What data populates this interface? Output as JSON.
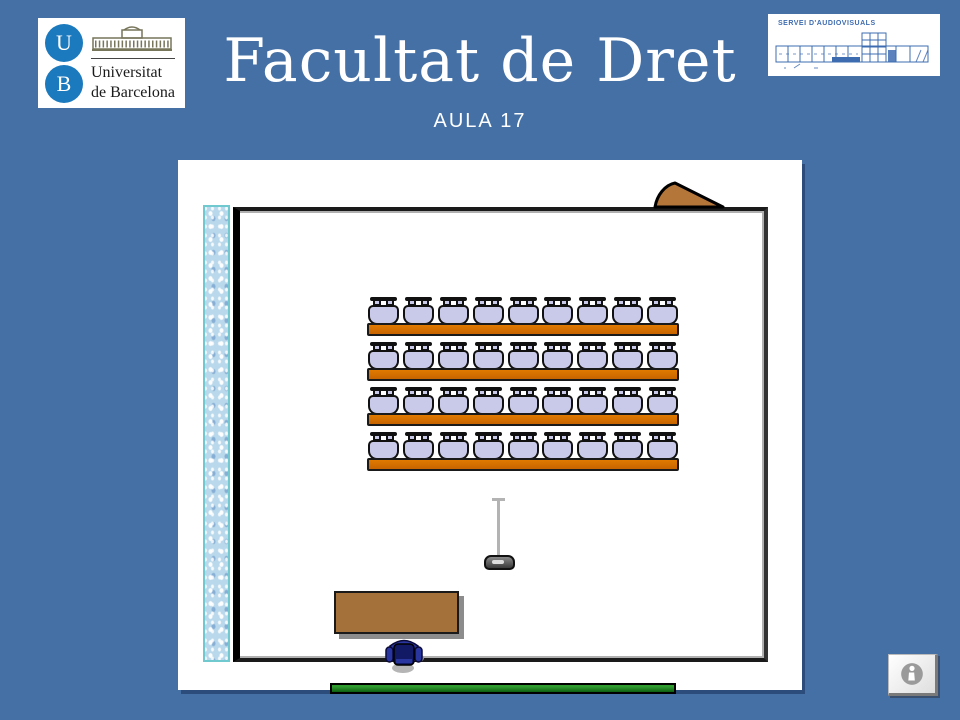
{
  "header": {
    "ub_logo": {
      "initials": [
        "U",
        "B"
      ],
      "name_lines": [
        "Universitat",
        "de Barcelona"
      ]
    },
    "title": "Facultat de Dret",
    "subtitle": "AULA 17",
    "sav_logo": {
      "label": "SERVEI D'AUDIOVISUALS"
    }
  },
  "floor_plan": {
    "rows": 4,
    "seats_per_row": 9,
    "features": [
      "window-strip",
      "door-icon",
      "student-desk",
      "student-chair",
      "projector-icon",
      "teacher-desk",
      "teacher-chair",
      "blackboard"
    ]
  },
  "footer": {
    "info_button": {
      "icon": "info-icon"
    }
  },
  "colors": {
    "background": "#4470A6",
    "logo_blue": "#1B79BD",
    "sav_blue": "#3E6CB0",
    "desk_orange": "#D06A00",
    "chair_lavender": "#C9C9EA",
    "wood_brown": "#A5713A",
    "door_brown": "#B5763A",
    "board_green": "#157015",
    "window_teal": "#6FC9CE"
  }
}
